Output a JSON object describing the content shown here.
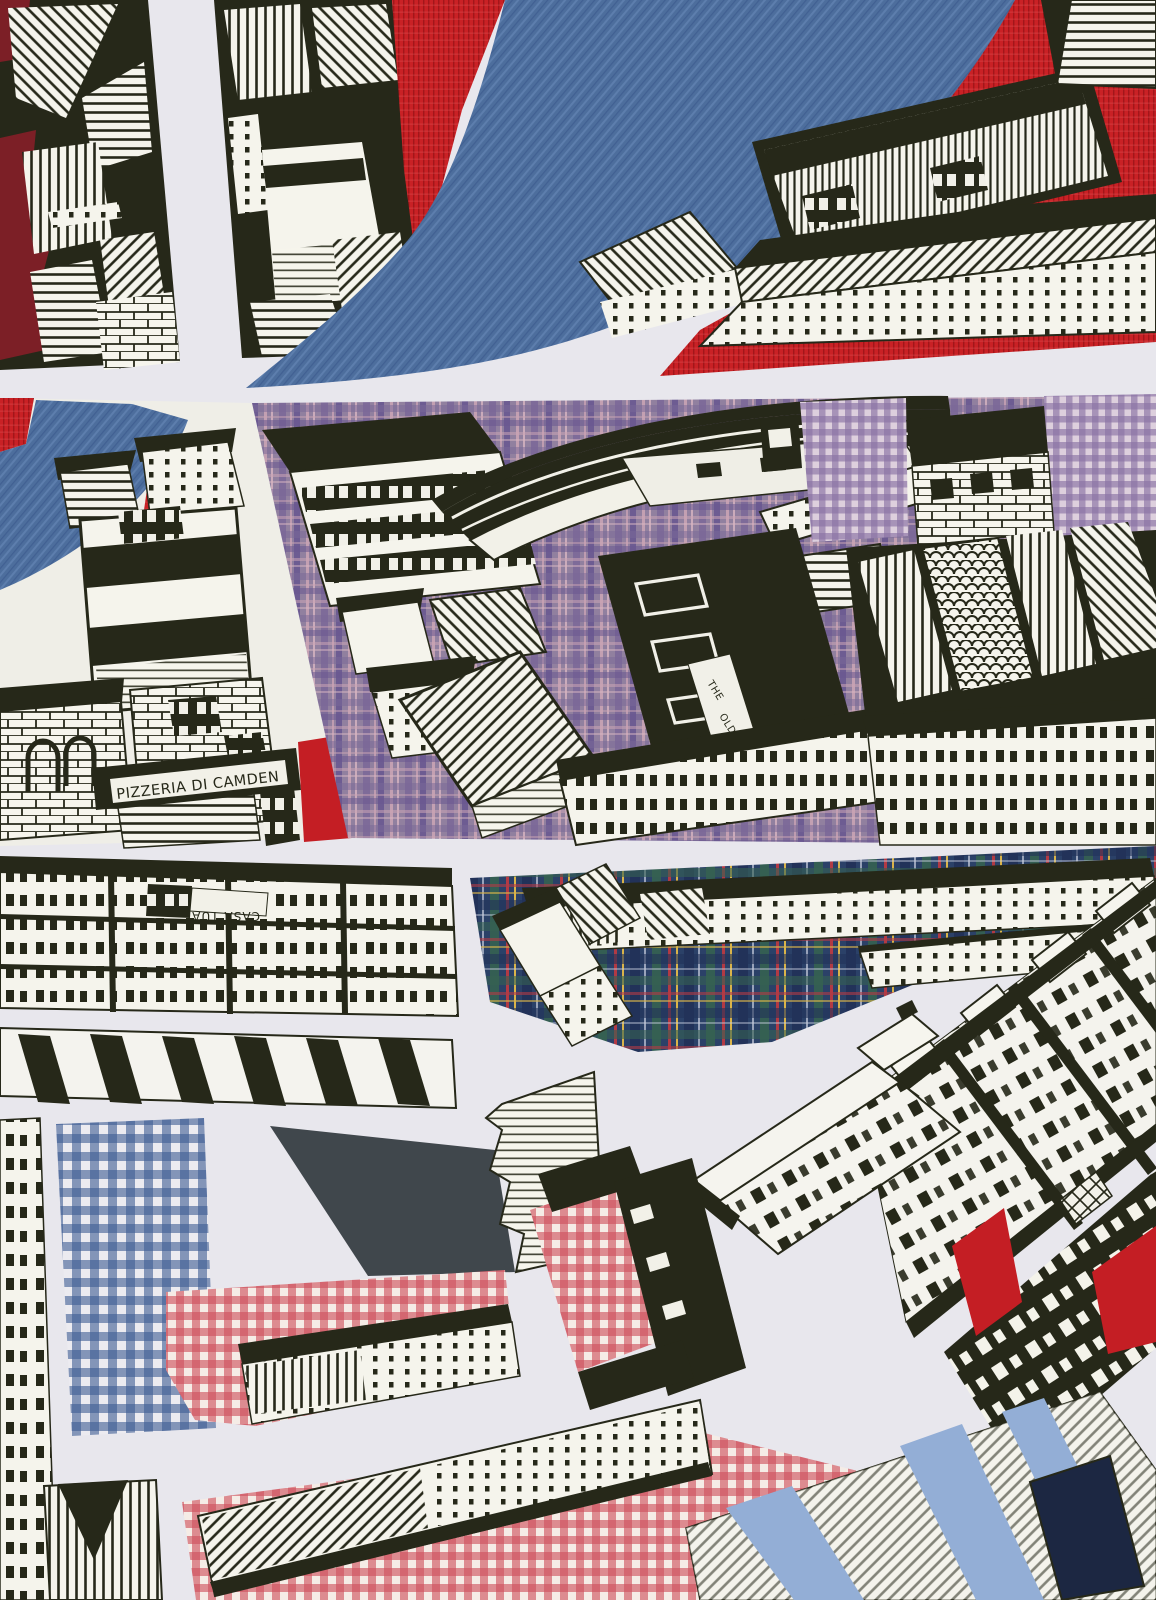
{
  "artwork": {
    "signs": {
      "pizzeria": "PIZZERIA DI CAMDEN",
      "pub_line1": "THE",
      "pub_line2": "OLD",
      "pub_line3": "EAGLE",
      "restaurant": "CASA TUA"
    },
    "palette": {
      "paper": "#e8e7ed",
      "ink": "#262819",
      "maroon": "#7c1f26",
      "red_fabric": "#c41e24",
      "denim_blue": "#4d6e9d",
      "plaid_purple": "#91809f",
      "gingham_blue": "#3d5c92",
      "gingham_red": "#cf4f5c",
      "tartan_navy": "#2b4168",
      "charcoal": "#40474c",
      "light_blue": "#93aed6",
      "navy": "#1c2742"
    }
  }
}
